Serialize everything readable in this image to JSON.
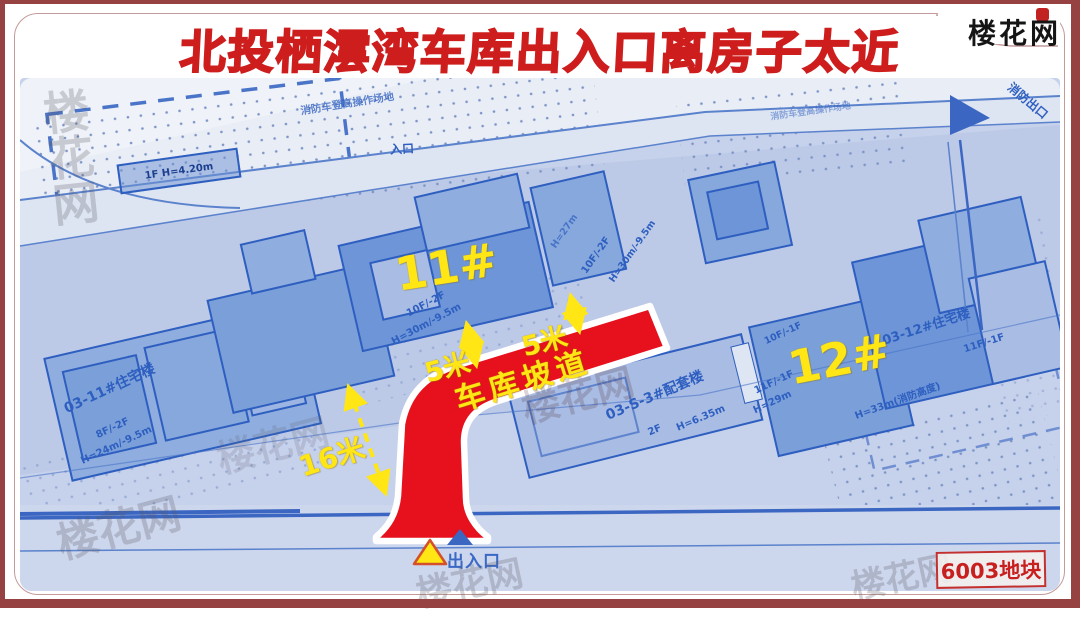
{
  "header": {
    "title": "北投栖澐湾车库出入口离房子太近",
    "logo_text": "楼花网"
  },
  "overlay": {
    "building_11_label": "11#",
    "building_12_label": "12#",
    "ramp_label": "车库坡道",
    "distance_labels": {
      "left_5m": "5米",
      "right_5m": "5米",
      "bottom_16m": "16米"
    },
    "entrance_label": "出入口",
    "parcel_badge": "6003地块"
  },
  "blueprint_labels": [
    "消防车登高操作场地",
    "入口",
    "1F H=4.20m",
    "03-11#住宅楼",
    "8F/-2F",
    "H=24m/-9.5m",
    "10F/-2F",
    "H=30m/-9.5m",
    "10F/-2F",
    "H=30m/-9.5m",
    "03-S-3#配套楼",
    "2F",
    "H=6.35m",
    "03-12#住宅楼",
    "11F/-1F",
    "H=33m(消防高度)",
    "11F/-1F",
    "H=29m",
    "10F/-1F",
    "消防出口",
    "消防车登高操作场地",
    "H=27m"
  ],
  "watermark_text": "楼花网",
  "colors": {
    "frame_maroon": "#964242",
    "title_red": "#ce1d1d",
    "ramp_red": "#e7101d",
    "annotation_yellow": "#ffe614",
    "blueprint_blue": "#2e5fc0"
  }
}
